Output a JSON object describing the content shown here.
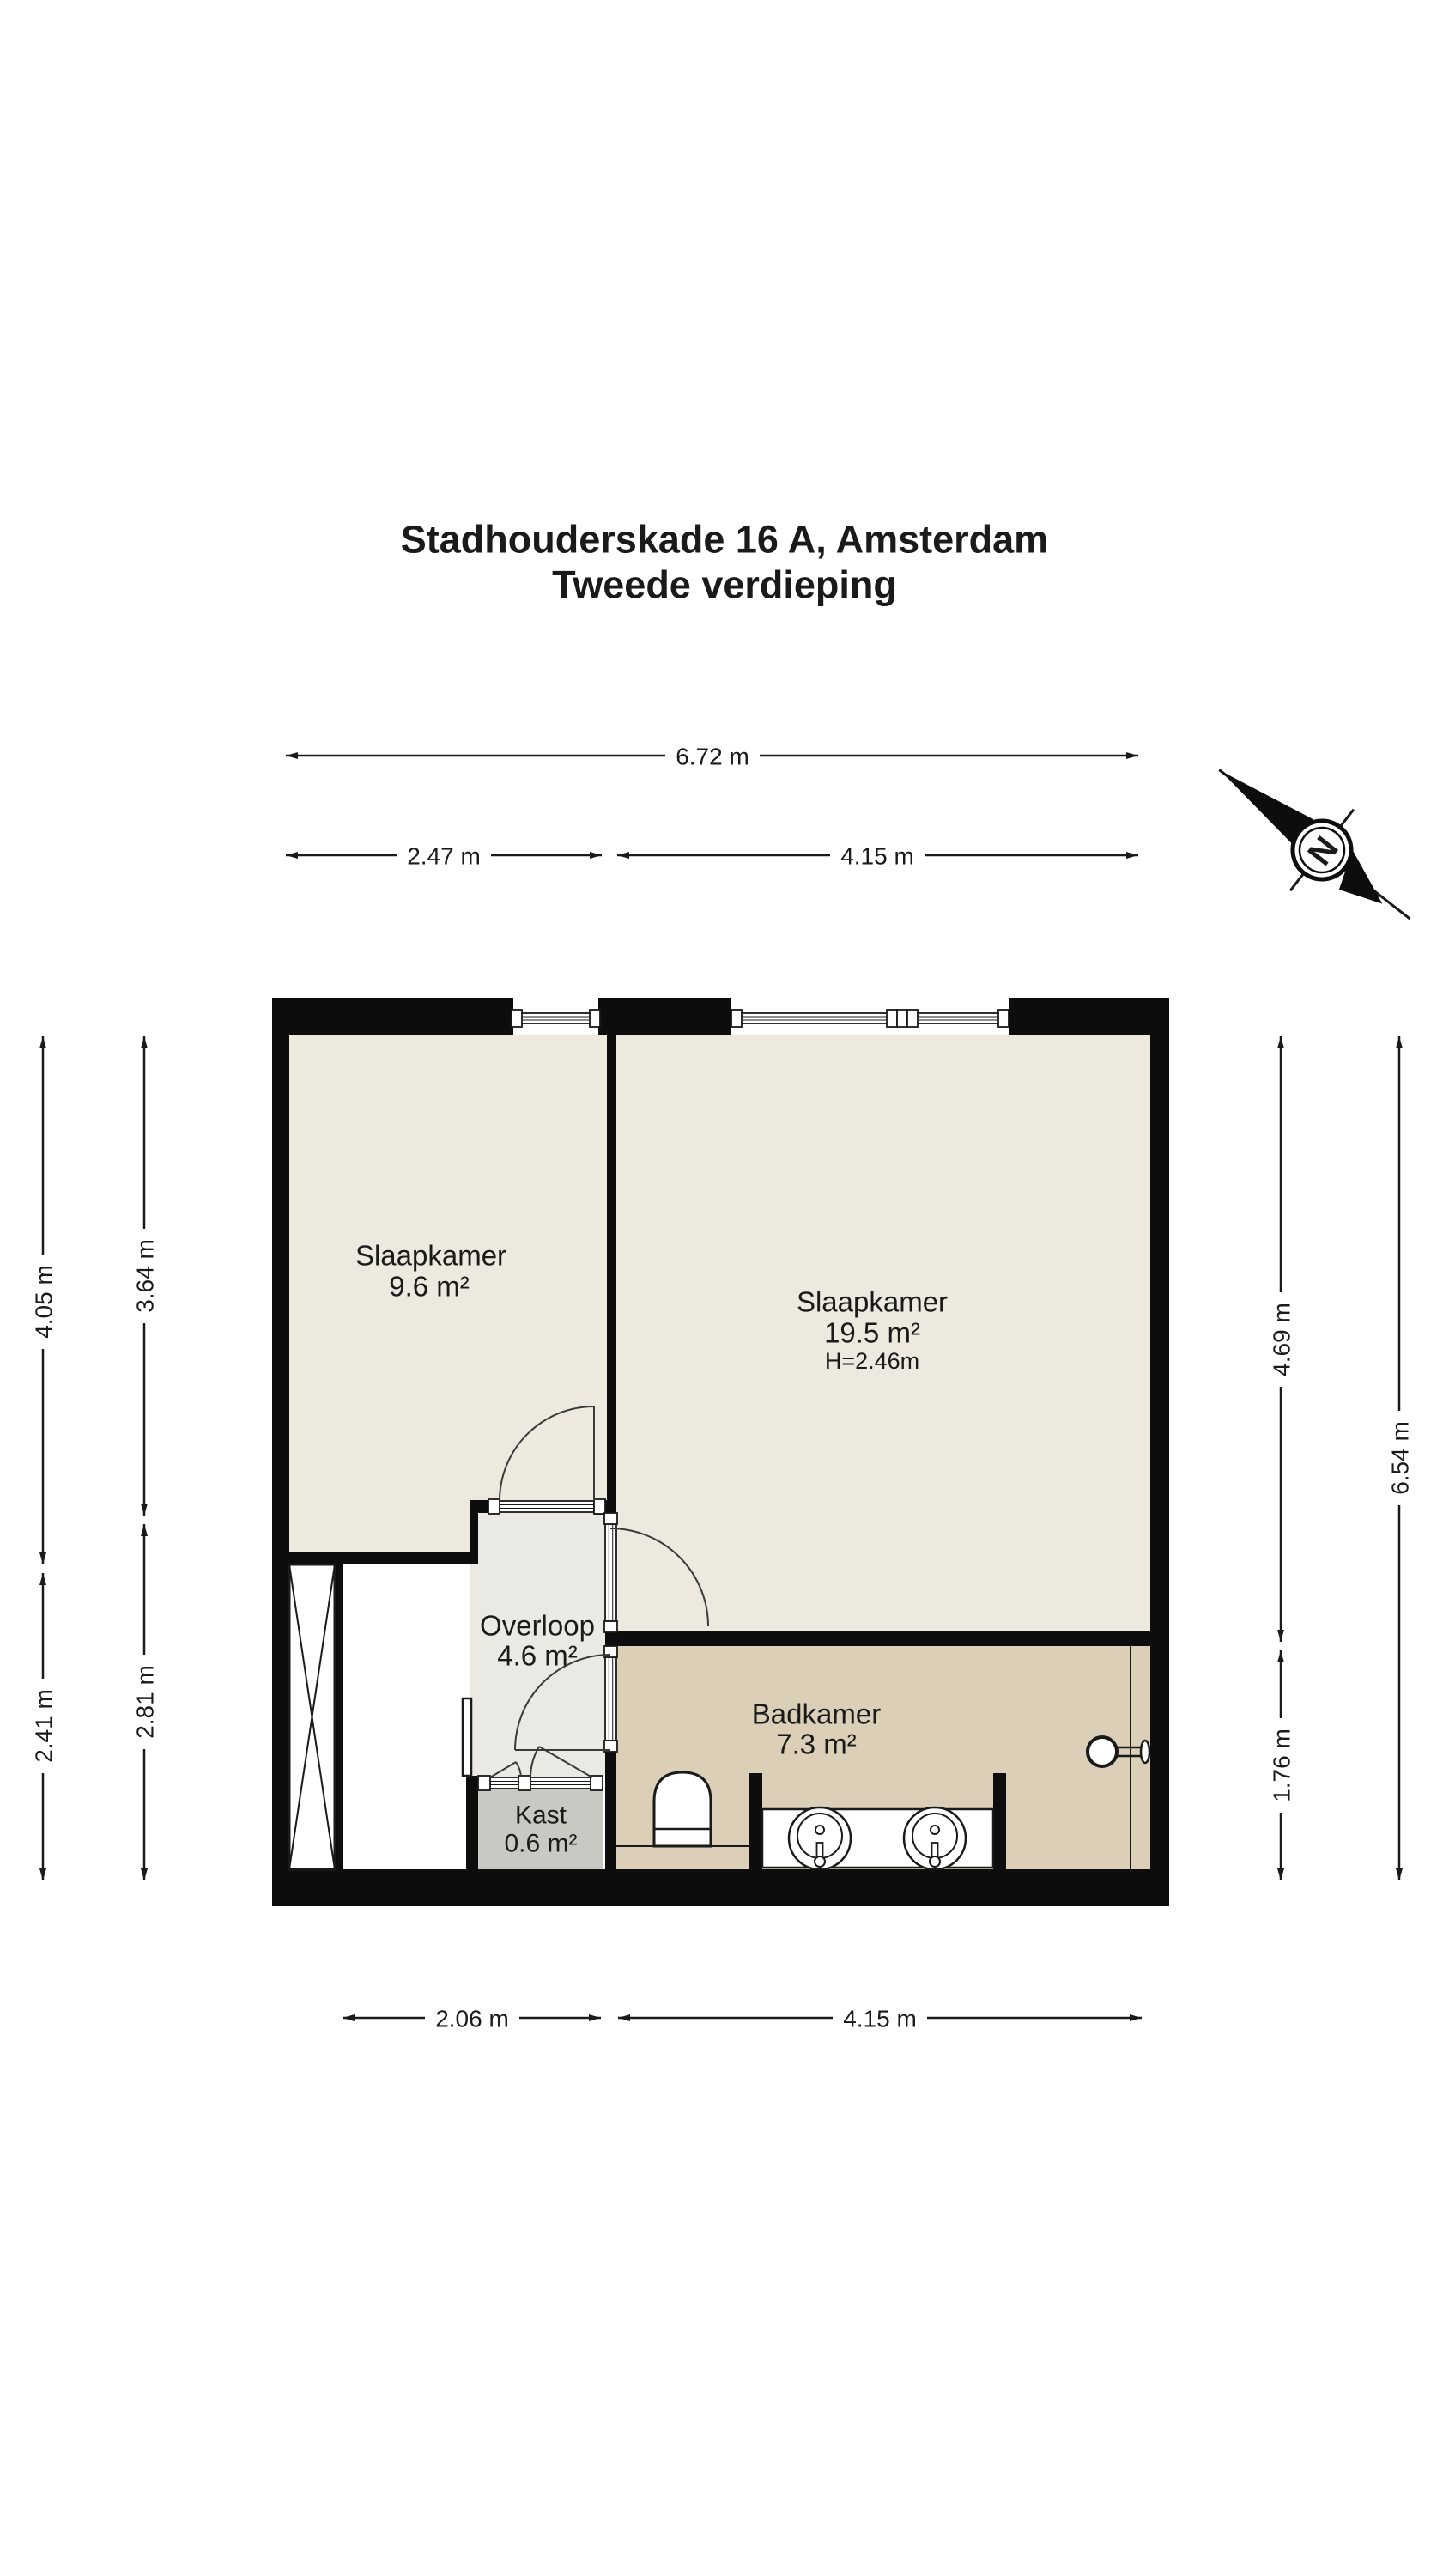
{
  "title": {
    "line1": "Stadhouderskade 16 A, Amsterdam",
    "line2": "Tweede verdieping"
  },
  "rooms": [
    {
      "name": "Slaapkamer",
      "area": "9.6 m²"
    },
    {
      "name": "Slaapkamer",
      "area": "19.5 m²",
      "height": "H=2.46m"
    },
    {
      "name": "Overloop",
      "area": "4.6 m²"
    },
    {
      "name": "Badkamer",
      "area": "7.3 m²"
    },
    {
      "name": "Kast",
      "area": "0.6 m²"
    }
  ],
  "dimensions": {
    "top_total": "6.72 m",
    "top_left": "2.47 m",
    "top_right": "4.15 m",
    "bottom_left": "2.06 m",
    "bottom_right": "4.15 m",
    "left_outer_top": "4.05 m",
    "left_outer_bottom": "2.41 m",
    "left_inner_top": "3.64 m",
    "left_inner_bottom": "2.81 m",
    "right_inner_top": "4.69 m",
    "right_inner_bottom": "1.76 m",
    "right_outer": "6.54 m"
  },
  "compass": {
    "north_label": "N"
  },
  "palette": {
    "wall": "#0d0d0d",
    "bedroom_fill": "#ede9de",
    "hall_fill": "#ebe9e4",
    "bathroom_fill": "#dbcfb7",
    "closet_fill": "#c9c8c3",
    "background": "#ffffff"
  }
}
